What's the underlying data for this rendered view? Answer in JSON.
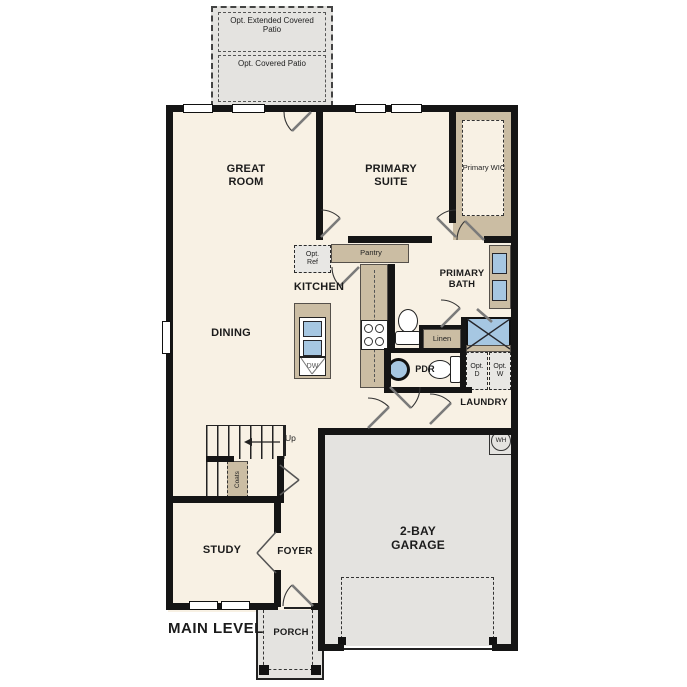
{
  "plan": {
    "main_level": "MAIN LEVEL",
    "patio": {
      "extended": "Opt. Extended Covered Patio",
      "covered": "Opt. Covered Patio"
    },
    "rooms": {
      "great_room": "GREAT ROOM",
      "primary_suite": "PRIMARY SUITE",
      "primary_wic": "Primary WIC",
      "kitchen": "KITCHEN",
      "dining": "DINING",
      "primary_bath": "PRIMARY BATH",
      "study": "STUDY",
      "foyer": "FOYER",
      "garage": "2-BAY GARAGE",
      "laundry": "LAUNDRY",
      "porch": "PORCH",
      "pdr": "PDR"
    },
    "features": {
      "pantry": "Pantry",
      "opt_ref": "Opt. Ref",
      "linen": "Linen",
      "dw": "DW",
      "opt_d": "Opt. D",
      "opt_w": "Opt. W",
      "up": "Up",
      "coats": "Coats",
      "wh": "WH"
    },
    "colors": {
      "wall": "#151515",
      "floor": "#f8f1e4",
      "cabinet_tan": "#cbbda3",
      "fixture_blue": "#a6c7e2",
      "exterior_gray": "#e4e3e0",
      "appliance_gray": "#e8e7e4"
    }
  }
}
